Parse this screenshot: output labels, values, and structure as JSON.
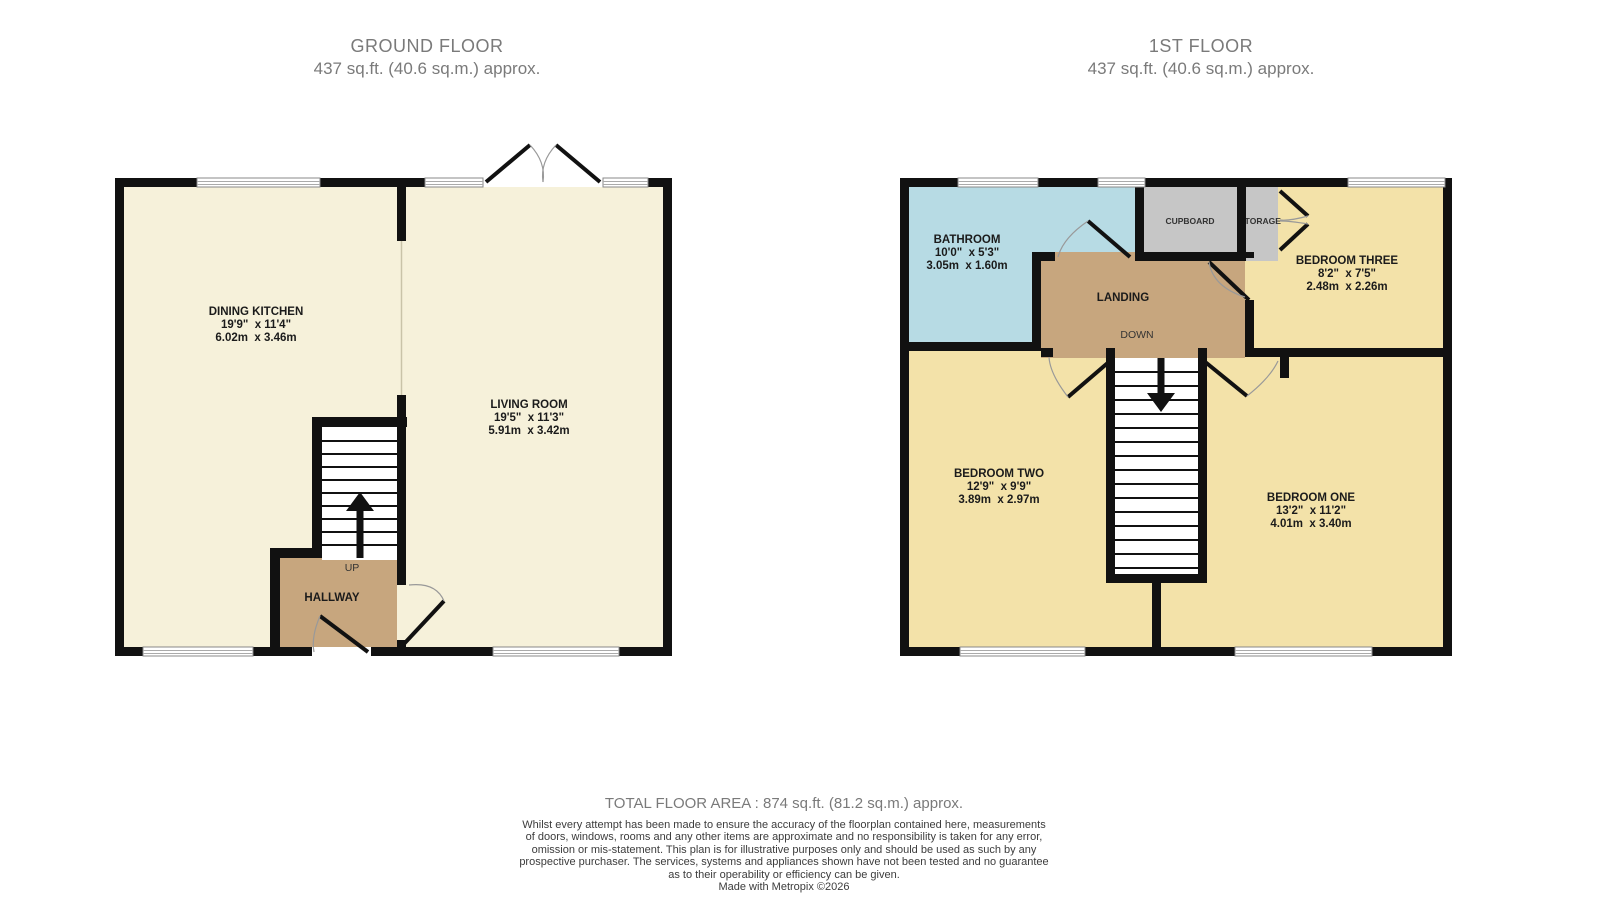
{
  "ground_floor": {
    "title": "GROUND FLOOR",
    "area": "437 sq.ft. (40.6 sq.m.) approx.",
    "rooms": {
      "dining_kitchen": {
        "name": "DINING KITCHEN",
        "imperial": "19'9\"  x 11'4\"",
        "metric": "6.02m  x 3.46m"
      },
      "living_room": {
        "name": "LIVING ROOM",
        "imperial": "19'5\"  x 11'3\"",
        "metric": "5.91m  x 3.42m"
      },
      "hallway": {
        "name": "HALLWAY"
      }
    },
    "stairs": {
      "direction": "UP"
    }
  },
  "first_floor": {
    "title": "1ST FLOOR",
    "area": "437 sq.ft. (40.6 sq.m.) approx.",
    "rooms": {
      "bathroom": {
        "name": "BATHROOM",
        "imperial": "10'0\"  x 5'3\"",
        "metric": "3.05m  x 1.60m"
      },
      "bedroom_three": {
        "name": "BEDROOM THREE",
        "imperial": "8'2\"  x 7'5\"",
        "metric": "2.48m  x 2.26m"
      },
      "bedroom_two": {
        "name": "BEDROOM TWO",
        "imperial": "12'9\"  x 9'9\"",
        "metric": "3.89m  x 2.97m"
      },
      "bedroom_one": {
        "name": "BEDROOM ONE",
        "imperial": "13'2\"  x 11'2\"",
        "metric": "4.01m  x 3.40m"
      },
      "landing": {
        "name": "LANDING"
      },
      "cupboard": {
        "name": "CUPBOARD"
      },
      "storage": {
        "name": "STORAGE"
      }
    },
    "stairs": {
      "direction": "DOWN"
    }
  },
  "footer": {
    "total_area": "TOTAL FLOOR AREA : 874 sq.ft. (81.2 sq.m.) approx.",
    "disclaimer_lines": [
      "Whilst every attempt has been made to ensure the accuracy of the floorplan contained here, measurements",
      "of doors, windows, rooms and any other items are approximate and no responsibility is taken for any error,",
      "omission or mis-statement. This plan is for illustrative purposes only and should be used as such by any",
      "prospective purchaser. The services, systems and appliances shown have not been tested and no guarantee",
      "as to their operability or efficiency can be given."
    ],
    "credit": "Made with Metropix ©2026"
  },
  "colors": {
    "wall": "#111111",
    "ground_floor_room": "#f6f1da",
    "bedroom": "#f3e2a9",
    "hall_landing": "#c7a67e",
    "bathroom": "#b7dbe4",
    "cupboard_gray": "#c6c6c6",
    "title_text": "#7a7a7a",
    "label_text": "#1b1b1b"
  }
}
